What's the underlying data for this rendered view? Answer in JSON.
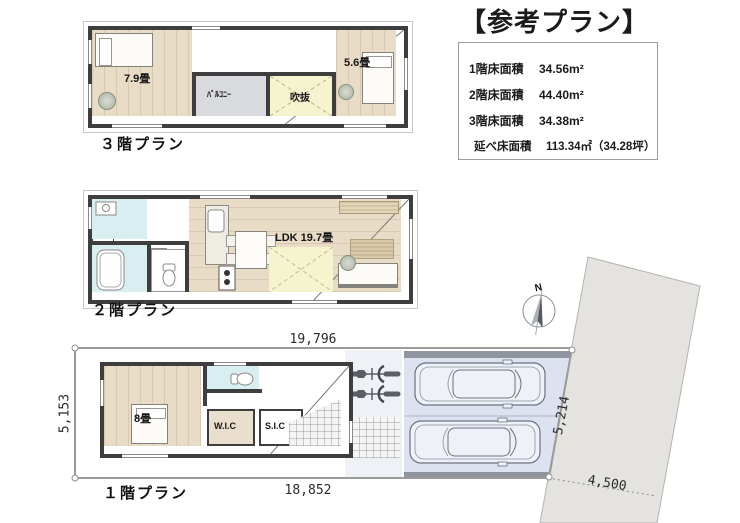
{
  "title": "【参考プラン】",
  "area_table": {
    "rows": [
      {
        "label": "1階床面積",
        "value": "34.56m²"
      },
      {
        "label": "2階床面積",
        "value": "44.40m²"
      },
      {
        "label": "3階床面積",
        "value": "34.38m²"
      },
      {
        "label": "延べ床面積",
        "value": "113.34㎡（34.28坪）"
      }
    ]
  },
  "floor3": {
    "label": "３階プラン",
    "room_left": "7.9畳",
    "room_right": "5.6畳",
    "balcony": "ﾊﾞﾙｺﾆｰ",
    "void": "吹抜"
  },
  "floor2": {
    "label": "２階プラン",
    "ldk": "LDK 19.7畳",
    "storage": "S",
    "fridge": "R"
  },
  "floor1": {
    "label": "１階プラン",
    "bedroom": "8畳",
    "wic": "W.I.C",
    "sic": "S.I.C"
  },
  "site": {
    "dim_top": "19,796",
    "dim_bottom": "18,852",
    "dim_left": "5,153",
    "dim_road_length": "5,214",
    "dim_road_width": "4,500",
    "compass_north": "N"
  },
  "colors": {
    "wall": "#3e3e3e",
    "wood_floor": "#e8dcc6",
    "sanitary_cyan": "#d8eef1",
    "void_yellow": "#f6f3cf",
    "balcony_gray": "#d9dade",
    "parking_blue": "#dce2ef",
    "road_gray": "#e4e3e0"
  }
}
